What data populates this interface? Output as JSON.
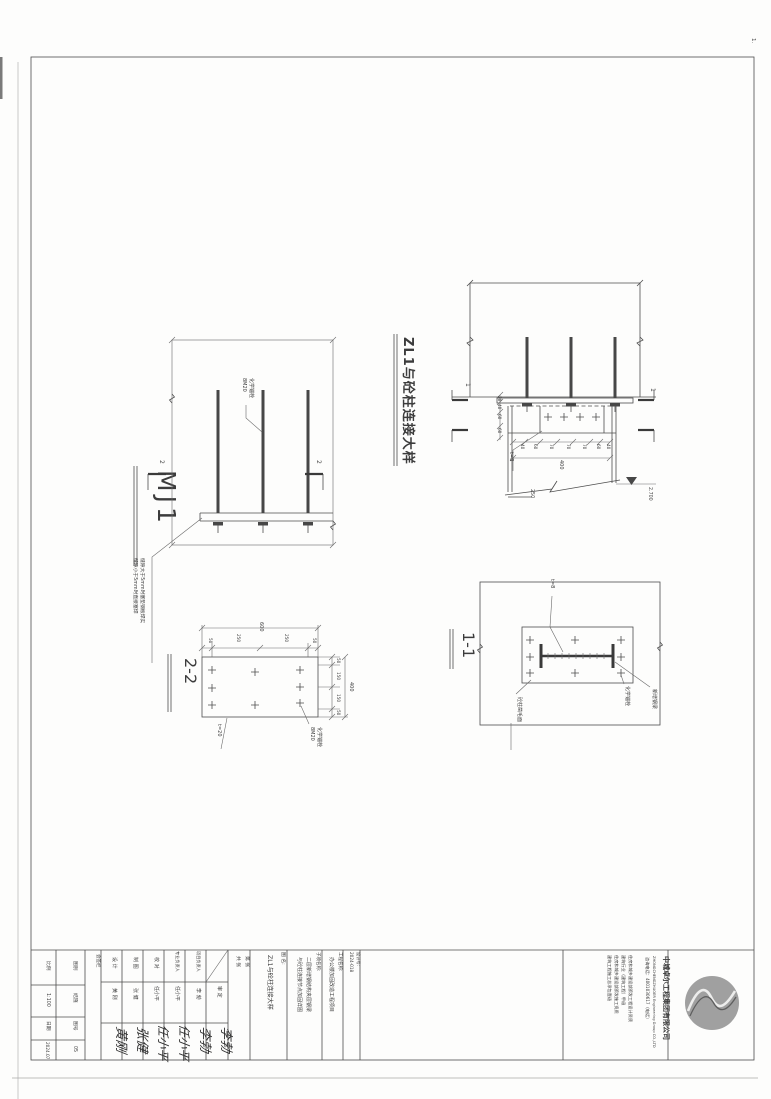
{
  "page": {
    "corner_mark": "1."
  },
  "titleblock": {
    "scale": {
      "bl": "比例",
      "bl_v": "1:100",
      "rq": "日期",
      "rq_v": "2024.07",
      "tb": "图别",
      "tb_v": "结施",
      "th": "图号",
      "th_v": "05"
    },
    "huiqian": "会签栏",
    "signs": [
      {
        "role": "设 计",
        "name": "黄 刚",
        "sig": "黄刚"
      },
      {
        "role": "制 图",
        "name": "张 健",
        "sig": "张健"
      },
      {
        "role": "校 对",
        "name": "任小平",
        "sig": "任小平"
      },
      {
        "role": "专业负责人",
        "name": "任小平",
        "sig": "任小平"
      },
      {
        "role": "项目负责人",
        "name": "李 勃",
        "sig": "李勃"
      },
      {
        "role": "",
        "name": "审 定",
        "sig": "李勃"
      }
    ],
    "sheet": {
      "line1": "第 张",
      "line2": "共 张"
    },
    "tuming_label": "图 名:",
    "tuming": "ZL1与砼柱连接大样",
    "sub_label": "子项名称:",
    "sub1": "二层新增钢结构夹层钢梁",
    "sub2": "与砼柱连接节点加固详图",
    "proj_label": "工程名称:",
    "proj": "办公楼加固改造工程项目",
    "jobno_label": "设计号:",
    "jobno": "2024-018",
    "certs": [
      "住房和城乡建设部颁发工程设计资质",
      "建筑行业（建筑工程）甲级",
      "住房和城乡建设部颁发施工资质",
      "建筑工程施工总承包壹级"
    ],
    "phone": "咨询电话：4001030617（电话）",
    "company_en": "ZHONGCHENGZHUOER Engineering Group CO.,LTD",
    "company": "中城卓尔工程集团有限公司"
  },
  "zl1": {
    "title": "ZL1与砼柱连接大样",
    "sec": "1",
    "left_dims": [
      "20",
      "40",
      "60",
      "60"
    ],
    "bot_dims": [
      "40",
      "60",
      "70",
      "70",
      "70",
      "60",
      "40"
    ],
    "total": "400",
    "t": "t=8",
    "w": "250",
    "level": "2.700"
  },
  "mj1": {
    "title": "MJ1",
    "sec": "2",
    "qty": "8M20",
    "anchor": "化学锚栓",
    "note1": "缝隙大于5mm时塞垫钢板焊实",
    "note2": "缝隙小于5mm时直接塞焊"
  },
  "s11": {
    "title": "1-1",
    "t": "t=8",
    "anchor": "化学锚栓",
    "beam": "新增钢梁",
    "surface": "砼柱凿毛面"
  },
  "s22": {
    "title": "2-2",
    "top_dims": [
      "50",
      "250",
      "250",
      "50"
    ],
    "top_total": "600",
    "side_dims": [
      "50",
      "150",
      "150",
      "50"
    ],
    "side_total": "400",
    "t": "t=20",
    "qty": "8M20",
    "anchor": "化学锚栓"
  }
}
